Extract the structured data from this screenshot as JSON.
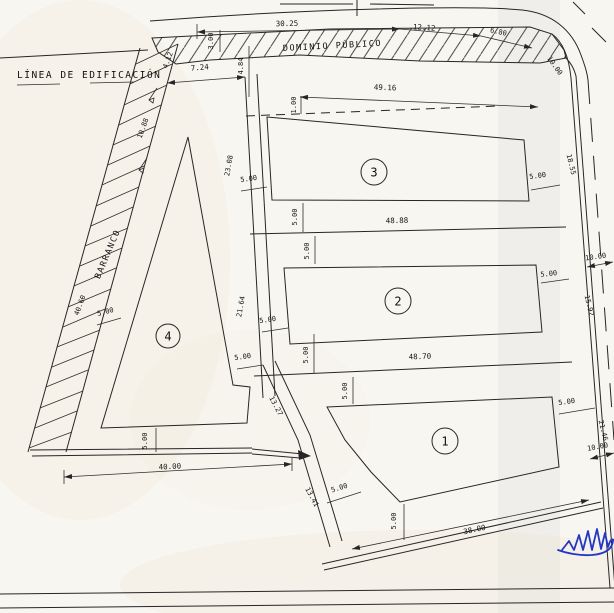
{
  "labels": {
    "linea_de_edificacion": "LÍNEA DE EDIFICACIÓN",
    "dominio_publico": "DOMINIO PÚBLICO",
    "barranco": "BARRANCO"
  },
  "parcels": [
    {
      "number": "1"
    },
    {
      "number": "2"
    },
    {
      "number": "3"
    },
    {
      "number": "4"
    }
  ],
  "dims": {
    "top_30_25": "30.25",
    "top_12_12": "12.12",
    "top_6_80": "6.80",
    "strip_width_3_00": "3.00",
    "curve_10_00": "10.00",
    "north_7_24": "7.24",
    "north_4_84": "4.84",
    "north_1_00": "1.00",
    "parcel3_front_49_16": "49.16",
    "parcel3_side_w": "5.00",
    "parcel3_side_e": "5.00",
    "gap_p3_s": "5.00",
    "mid_48_88": "48.88",
    "gap_p2_n": "5.00",
    "west_23_08": "23.08",
    "west_21_64": "21.64",
    "road_18_55": "18.55",
    "road_width_10_00_mid": "10.00",
    "parcel2_side_e": "5.00",
    "parcel2_side_w": "5.00",
    "corridor_width_5_00": "5.00",
    "gap_p2_s": "5.00",
    "mid_48_70": "48.70",
    "gap_p1_n": "5.00",
    "diag_13_27": "13.27",
    "road_15_92": "15.92",
    "parcel1_side_e": "5.00",
    "road_21_46": "21.46",
    "road_width_10_00_low": "10.00",
    "diag_13_41": "13.41",
    "parcel1_corner_sw": "5.00",
    "parcel1_side_s": "5.00",
    "south_38_00": "38.00",
    "parcel4_offset_nw": "5.00",
    "parcel4_side_s": "5.00",
    "south_40_00": "40.00",
    "barranco_4_12": "4.12",
    "barranco_10_88": "10.88",
    "barranco_40_60": "40.60"
  },
  "colors": {
    "ink": "#262626",
    "signature_blue": "#2336c4",
    "paper": "#f8f6f1"
  }
}
